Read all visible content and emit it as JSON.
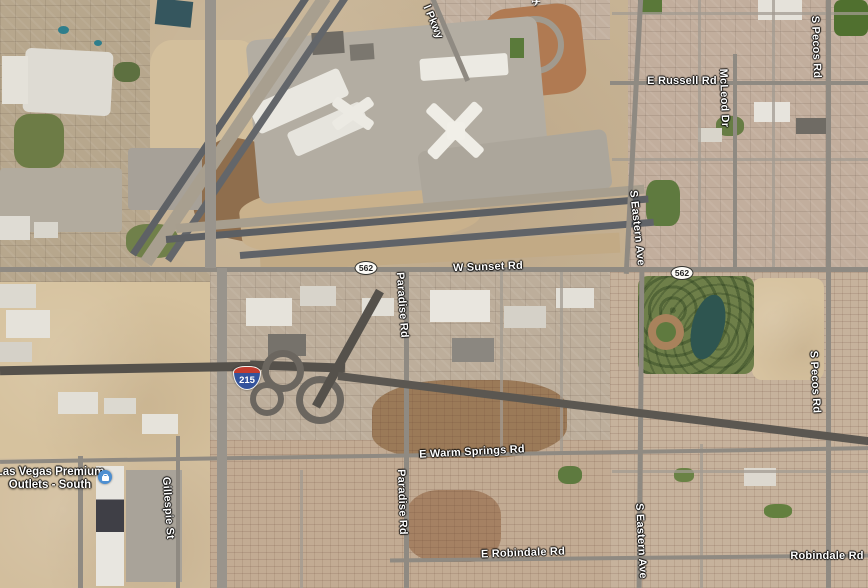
{
  "map": {
    "view": "Satellite",
    "labels": {
      "pkwy_partial": "l Pkwy",
      "russell": "E Russell Rd",
      "mcleod": "McLeod Dr",
      "pecos_top": "S Pecos Rd",
      "sunset": "W Sunset Rd",
      "paradise_upper": "Paradise Rd",
      "eastern_upper": "S Eastern Ave",
      "pecos_mid": "S Pecos Rd",
      "warm_springs": "E Warm Springs Rd",
      "gillespie": "Gillespie St",
      "paradise_lower": "Paradise Rd",
      "robindale_left": "E Robindale Rd",
      "eastern_lower": "S Eastern Ave",
      "robindale_right": "Robindale Rd"
    },
    "shields": {
      "sr562_west": "562",
      "sr562_east": "562",
      "i215": "215"
    },
    "poi": {
      "outlets_line1": "Las Vegas Premium",
      "outlets_line2": "Outlets - South"
    },
    "icons": [
      "shopping-bag-icon",
      "airplane-icon"
    ],
    "colors": {
      "label_text": "#ffffff",
      "label_outline": "#000000",
      "route_shield_fill": "#fcfbf7",
      "interstate_blue": "#33539c",
      "interstate_red": "#c23b2e",
      "poi_icon_blue": "#4d8fd1"
    }
  }
}
